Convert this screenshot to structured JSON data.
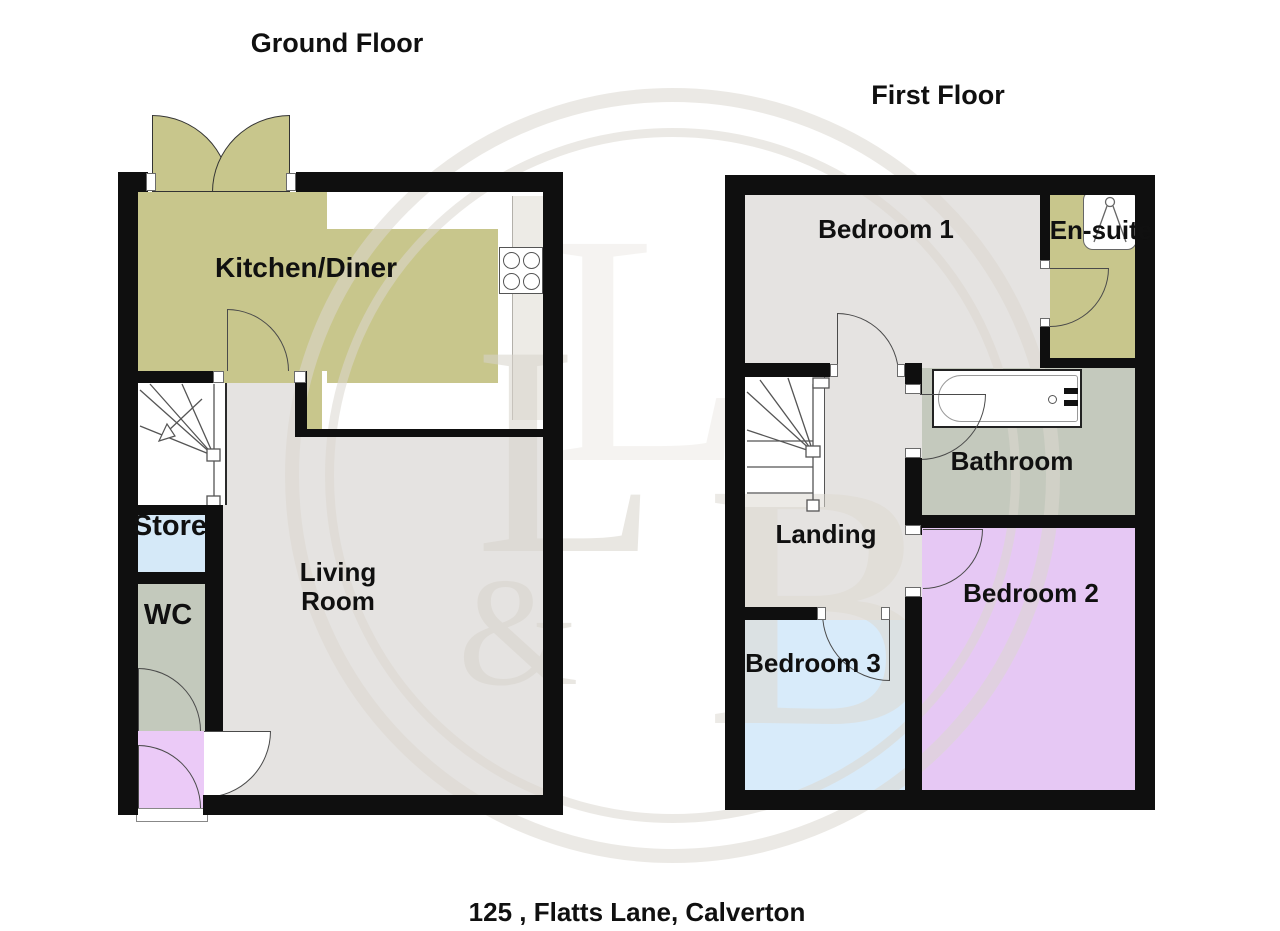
{
  "caption": "125 , Flatts Lane, Calverton",
  "floors": {
    "ground": {
      "title": "Ground Floor",
      "rooms": {
        "kitchen": {
          "label": "Kitchen/Diner",
          "color": "#c8c68c"
        },
        "living": {
          "label": "Living Room",
          "color": "#e5e3e1"
        },
        "store": {
          "label": "Store",
          "color": "#d5e9f8"
        },
        "wc": {
          "label": "WC",
          "color": "#c3c9bc"
        },
        "hall": {
          "label": "",
          "color": "#ebcaf7"
        }
      }
    },
    "first": {
      "title": "First Floor",
      "rooms": {
        "bedroom1": {
          "label": "Bedroom 1",
          "color": "#e5e3e1"
        },
        "ensuite": {
          "label": "En-suite",
          "color": "#c8c68c"
        },
        "bathroom": {
          "label": "Bathroom",
          "color": "#c4c9bd"
        },
        "landing": {
          "label": "Landing",
          "color": "#e5e3e1"
        },
        "bedroom2": {
          "label": "Bedroom 2",
          "color": "#e6c8f4"
        },
        "bedroom3": {
          "label": "Bedroom 3",
          "color": "#d8ebfa"
        }
      }
    }
  },
  "watermark": {
    "letters": [
      "L",
      "&",
      "B"
    ]
  },
  "colors": {
    "wall": "#0f0f0f",
    "olive": "#c8c68c",
    "floor_gray": "#e5e3e1",
    "bath_gray": "#c4c9bd",
    "store_blue": "#d5e9f8",
    "bed3_blue": "#d8ebfa",
    "hall_purple": "#ebcaf7",
    "bed2_purple": "#e6c8f4",
    "watermark_gray": "#d8d4cc"
  }
}
